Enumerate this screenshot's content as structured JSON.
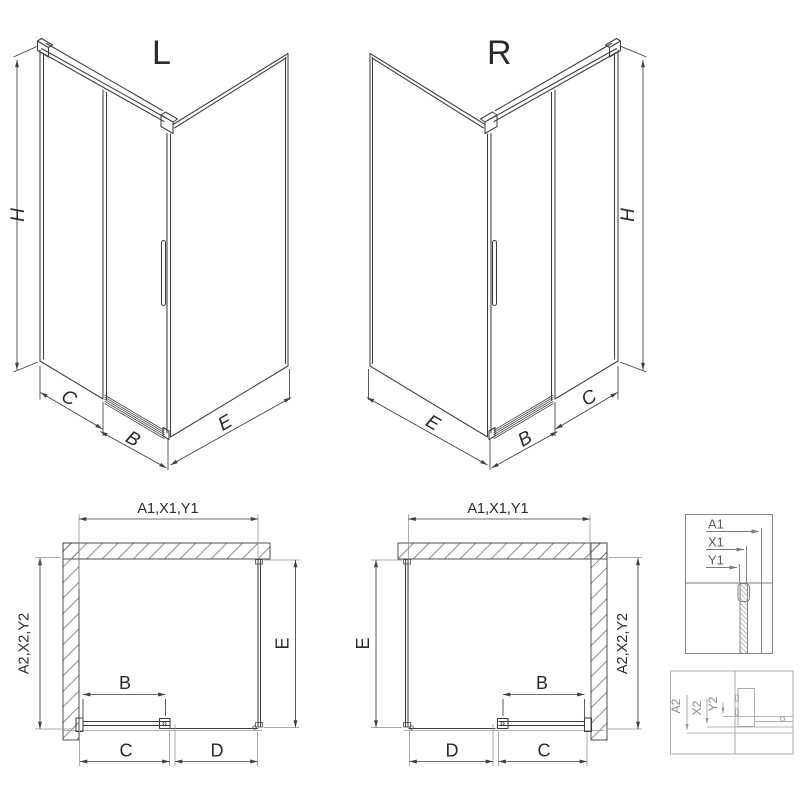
{
  "drawing": {
    "type": "shower-enclosure-technical-diagram",
    "iso_left": {
      "title": "L",
      "h": "H",
      "c": "C",
      "b": "B",
      "e": "E"
    },
    "iso_right": {
      "title": "R",
      "h": "H",
      "e": "E",
      "b": "B",
      "c": "C"
    },
    "plan_left": {
      "top": "A1,X1,Y1",
      "side_left": "A2,X2,Y2",
      "side_right": "E",
      "door": "B",
      "bottom_left": "C",
      "bottom_right": "D"
    },
    "plan_right": {
      "top": "A1,X1,Y1",
      "side_left": "E",
      "side_right": "A2,X2,Y2",
      "door": "B",
      "bottom_left": "D",
      "bottom_right": "C"
    },
    "detail_top": {
      "rows": [
        "A1",
        "X1",
        "Y1"
      ]
    },
    "detail_bottom": {
      "rows": [
        "A2",
        "X2",
        "Y2"
      ]
    }
  },
  "colors": {
    "background": "#ffffff",
    "model_line": "#3d3d3d",
    "dimension_line": "#3f3f3f",
    "extension_line": "#909090",
    "detail_top_line": "#7a7a7a",
    "detail_bottom_line": "#9a9a9a",
    "hatch": "#6e6e6e",
    "text": "#2a2a2a"
  }
}
